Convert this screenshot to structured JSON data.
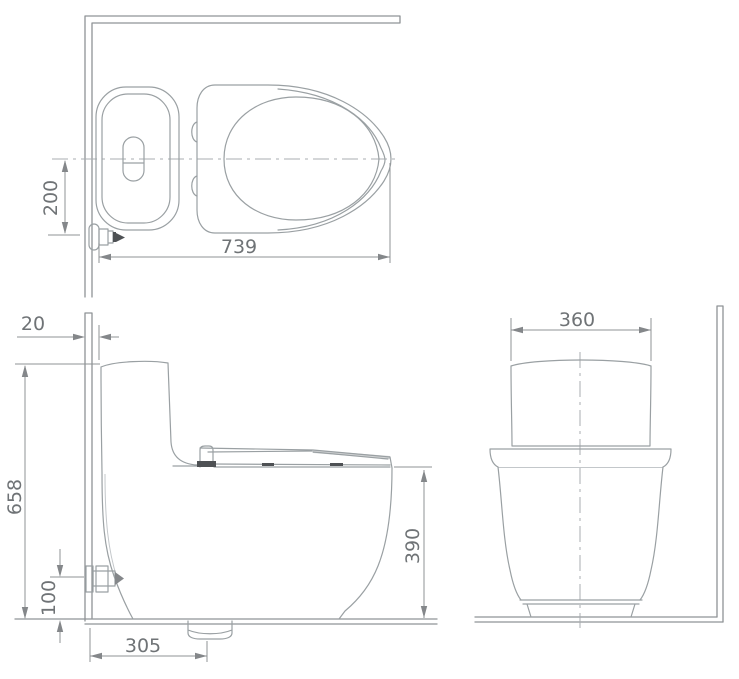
{
  "colors": {
    "background": "#ffffff",
    "outline": "#9aa0a3",
    "dimension_line": "#8f9396",
    "dimension_text": "#6f7376",
    "dark_accent": "#4e5154"
  },
  "dimensions": {
    "top_offset": "200",
    "top_depth": "739",
    "side_wall_gap": "20",
    "side_overall_height": "658",
    "side_inlet_height": "100",
    "side_drain_setout": "305",
    "side_rim_height": "390",
    "front_width": "360"
  }
}
